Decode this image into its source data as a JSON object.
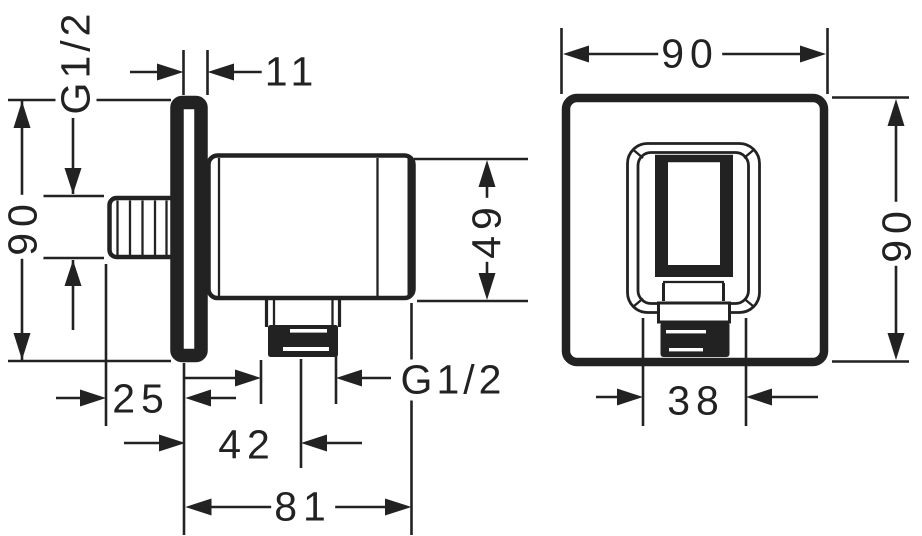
{
  "colors": {
    "background": "#ffffff",
    "ink": "#222222"
  },
  "side_view": {
    "g12_inlet": "G1/2",
    "plate_height": "90",
    "plate_thickness": "11",
    "body_diameter": "49",
    "inlet_length": "25",
    "outlet_axis_depth": "42",
    "total_depth": "81",
    "g12_outlet": "G1/2"
  },
  "front_view": {
    "width": "90",
    "height": "90",
    "holder_width": "38"
  }
}
